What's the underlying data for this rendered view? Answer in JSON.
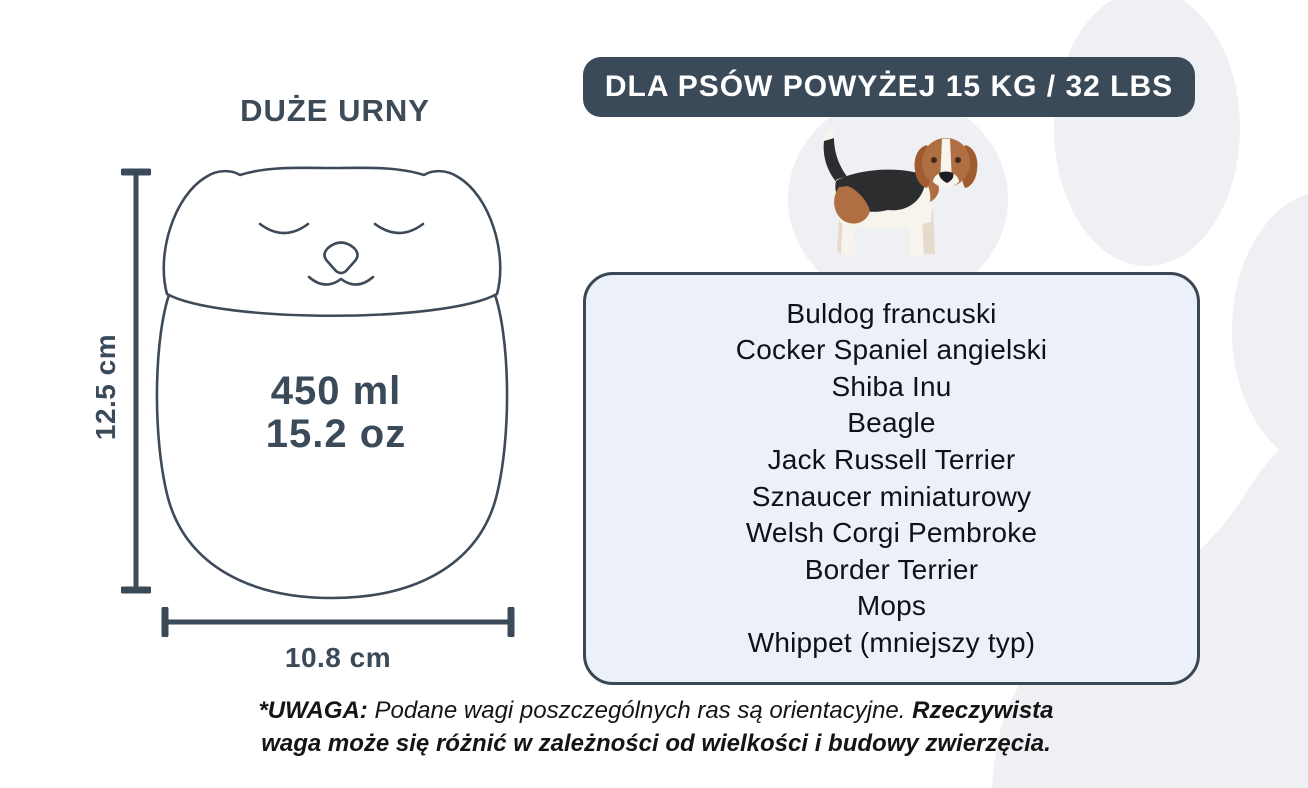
{
  "infographic": {
    "title": "DUŻE URNY",
    "banner_label": "DLA PSÓW POWYŻEJ 15 KG / 32 LBS",
    "urn": {
      "height_label": "12.5 cm",
      "width_label": "10.8 cm",
      "volume_ml": "450 ml",
      "volume_oz": "15.2 oz"
    },
    "breeds": {
      "items": [
        "Buldog francuski",
        "Cocker Spaniel angielski",
        "Shiba Inu",
        "Beagle",
        "Jack Russell Terrier",
        "Sznaucer miniaturowy",
        "Welsh Corgi Pembroke",
        "Border Terrier",
        "Mops",
        "Whippet (mniejszy typ)"
      ]
    },
    "note": {
      "label_bold": "*UWAGA:",
      "text_regular": "Podane wagi poszczególnych ras są orientacyjne.",
      "text_bold": "Rzeczywista waga może się różnić w zależności od wielkości i budowy zwierzęcia."
    },
    "icons": {
      "dog": "beagle-illustration",
      "urn": "sleeping-cat-urn-drawing",
      "background": "paw-print-shape"
    },
    "colors": {
      "dark_slate": "#3b4a59",
      "banner_text": "#ffffff",
      "card_bg": "#ecf1f9",
      "card_border": "#3a4754",
      "paw_gray": "#eef0f3",
      "note_text": "#141414",
      "dog_brown": "#b06f42",
      "dog_black": "#2c2d2f",
      "dog_cream": "#f7f3ed"
    }
  }
}
